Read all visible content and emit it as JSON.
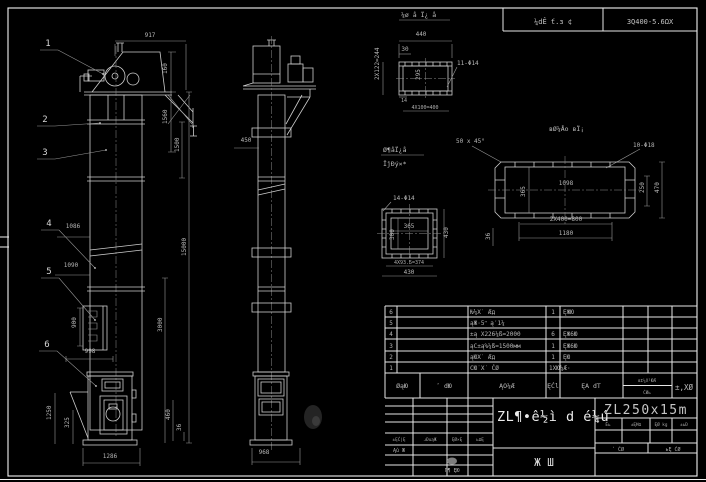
{
  "header": {
    "mid": "¼dÊ ť.з ¢",
    "right": "3Q400-5.6ΩX"
  },
  "front_view": {
    "balloons": [
      "1",
      "2",
      "3",
      "4",
      "5",
      "6"
    ],
    "dims": {
      "top_width": "917",
      "d160": "160",
      "d1560": "1560",
      "d1500": "1500",
      "total_height": "15000",
      "d3000": "3000",
      "d460": "460",
      "d36": "36",
      "d1086": "1086",
      "d1090": "1090",
      "d900": "900",
      "d998": "998",
      "d1250": "1250",
      "d325": "325",
      "base_width": "1286"
    }
  },
  "side_view": {
    "dims": {
      "d450": "450",
      "base_width": "968"
    }
  },
  "detail_top_flange": {
    "title": "¼ø å Ï¿ å",
    "dims": {
      "w": "440",
      "d30": "30",
      "holes": "11-Φ14",
      "inner": "295",
      "left": "2X122=244",
      "d14": "14",
      "bottom": "4X100=400"
    }
  },
  "detail_outlet_flange": {
    "title": "вØ¼Åо вЇ¡",
    "chamfer": "50 x 45°",
    "holes": "10-Φ18",
    "dims": {
      "inner_len": "1098",
      "inner_h": "365",
      "right1": "250",
      "right2": "470",
      "bottom1": "2X400=800",
      "bottom2": "1180",
      "left": "36"
    }
  },
  "detail_square_flange": {
    "title1": "Ø¶åÏ¿å",
    "title2": "ÏĵÐý×*",
    "holes": "14-Φ14",
    "dims": {
      "inner": "365",
      "left": "300",
      "right": "430",
      "bottom1": "4X93.5=374",
      "bottom2": "430"
    }
  },
  "parts_table": {
    "rows": [
      {
        "no": "6",
        "code": "",
        "name": "Ƕ¼X˙ Æд",
        "qty": "1",
        "material": "ĘЖЮ"
      },
      {
        "no": "5",
        "code": "",
        "name": "ąЖ·5ʺ ą′1¼",
        "qty": "",
        "material": ""
      },
      {
        "no": "4",
        "code": "",
        "name": "±ą X226¼ß=2000",
        "qty": "6",
        "material": "ĘЖ6Ю"
      },
      {
        "no": "3",
        "code": "",
        "name": "ąC±ą%¼ß=1500мм",
        "qty": "1",
        "material": "ĘЖ6Ю"
      },
      {
        "no": "2",
        "code": "",
        "name": "ąЮX˙ Æд",
        "qty": "1",
        "material": "ĘЮ"
      },
      {
        "no": "1",
        "code": "",
        "name": "CЮ˙X˙ ĆØ",
        "qty": "1XЮ¼Æ·",
        "material": ""
      }
    ],
    "footer": {
      "c1": "ØąЮ",
      "c2": "ʹ dЮ",
      "c3": "ĄO¼Æ",
      "c4": "ĘĆl",
      "c5": "ĘA dT",
      "c6a": "вΣ¼X¹ЮÆ",
      "c6b": "ĆØь",
      "c7": "±,XØ"
    }
  },
  "title_block": {
    "product": "ZL¶•ê½ì d é¼ú",
    "model": "ZL250x15m",
    "sheet_label": "Ж  Ш",
    "rev_header": [
      "±ĘĆ|Ę",
      "ɹÐuąЖ",
      "ĘØ×Ę",
      "ьΩĘ"
    ],
    "rev_row": "Ąû Ж",
    "rev_bottom": "Ґ¶ ĘЮ",
    "info_cells": [
      "׶Ĕь",
      "±ĘĦΩ",
      "ĘØ kg",
      "±ьĐ"
    ],
    "sheets": {
      "total": "ʹ ĆØ",
      "page": "ьĘ ĆØ"
    }
  }
}
